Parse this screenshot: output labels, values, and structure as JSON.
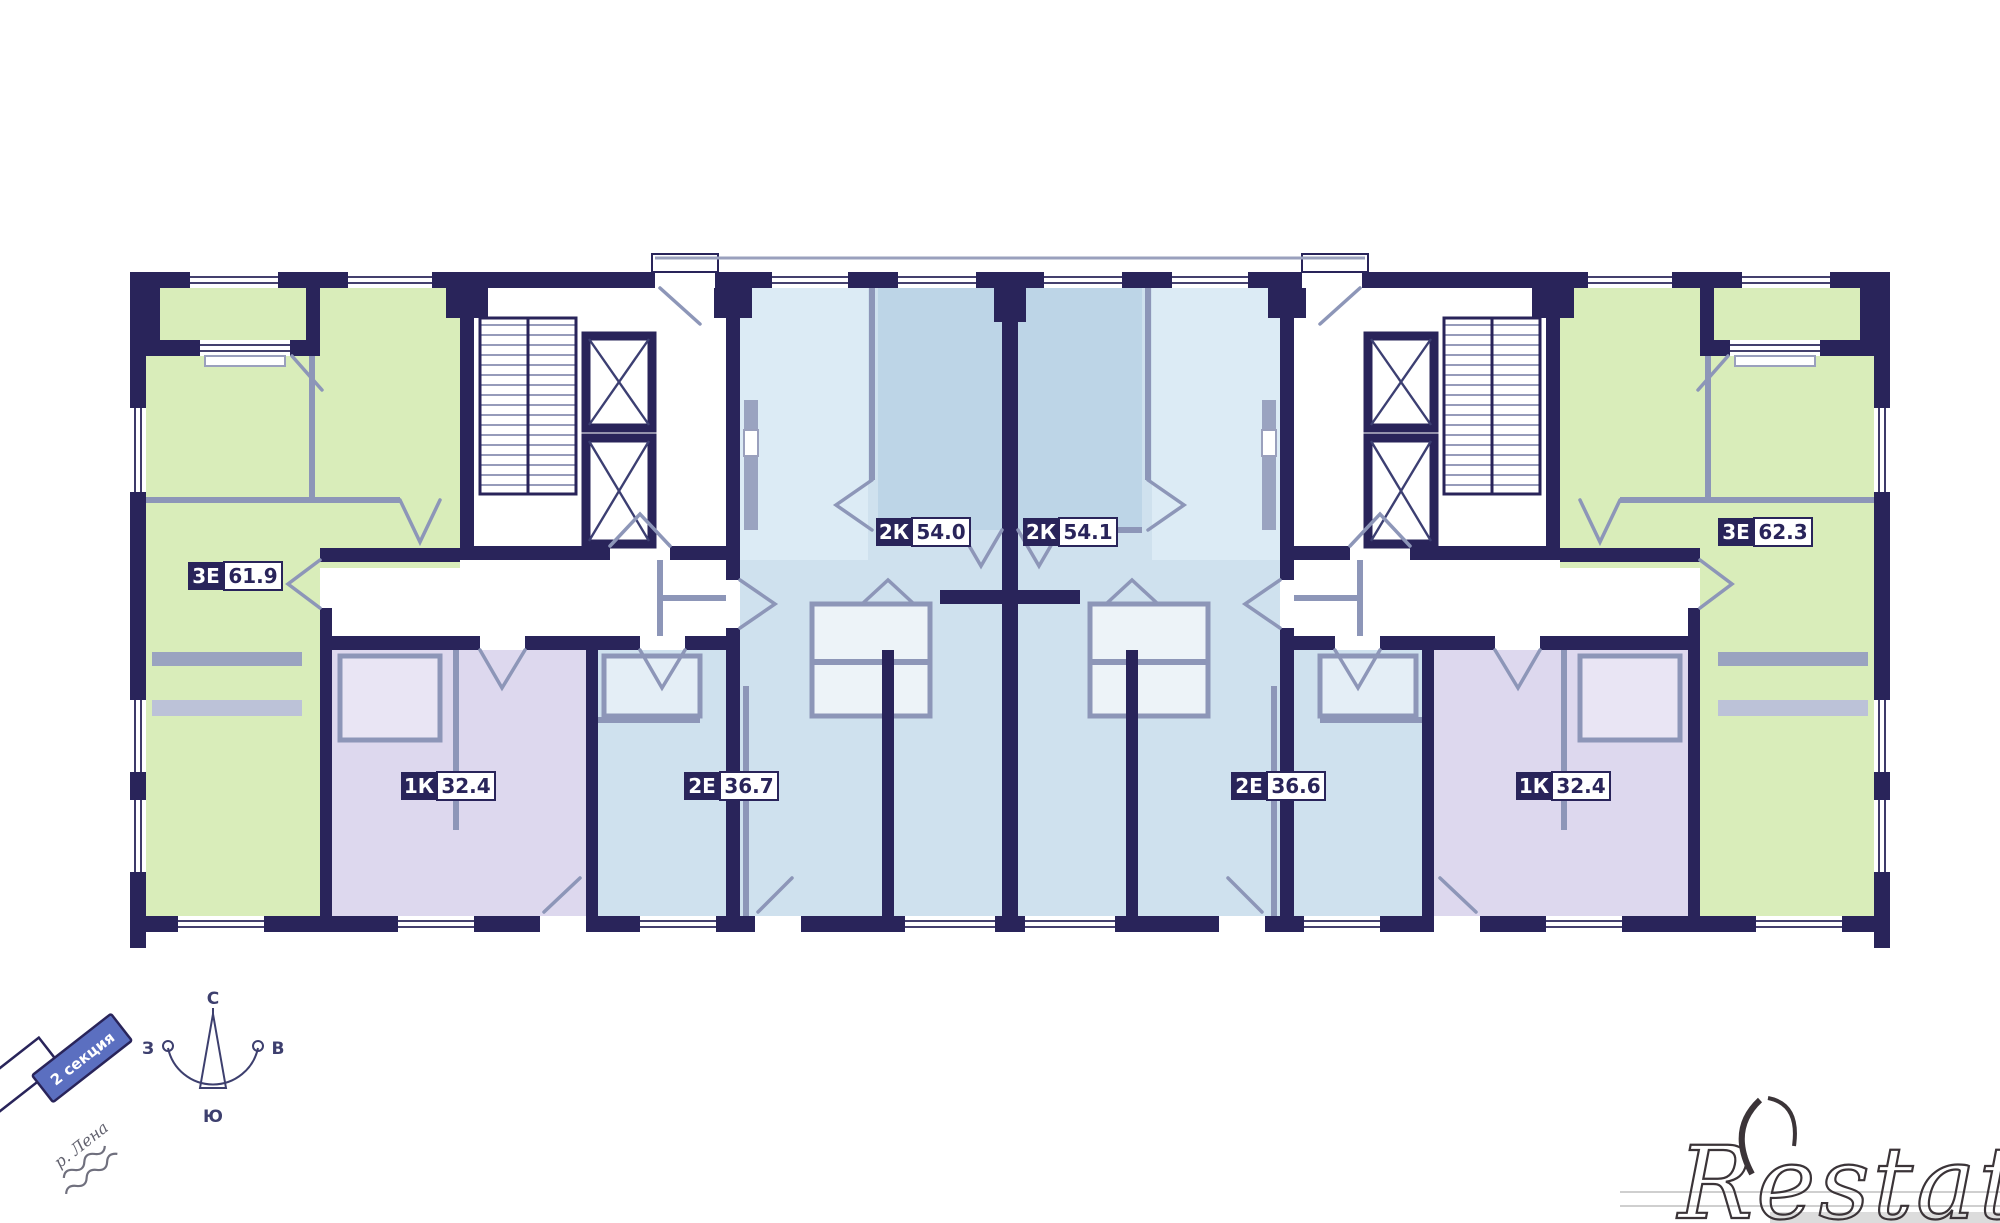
{
  "plan": {
    "apartments": [
      {
        "type": "3Е",
        "area": "61.9"
      },
      {
        "type": "1К",
        "area": "32.4"
      },
      {
        "type": "2Е",
        "area": "36.7"
      },
      {
        "type": "2К",
        "area": "54.0"
      },
      {
        "type": "2К",
        "area": "54.1"
      },
      {
        "type": "2Е",
        "area": "36.6"
      },
      {
        "type": "1К",
        "area": "32.4"
      },
      {
        "type": "3Е",
        "area": "62.3"
      }
    ]
  },
  "compass": {
    "north": "С",
    "east": "В",
    "south": "Ю",
    "west": "З"
  },
  "labels": {
    "section": "2 секция",
    "river": "р. Лена",
    "watermark": "Restate"
  },
  "legend_colors": {
    "walls": "#29245a",
    "apartment_green": "#d9edba",
    "apartment_blue": "#cfe1ee",
    "apartment_blue_dark": "#bdd5e7",
    "apartment_lavender": "#ddd8ee",
    "partition_gray": "#8d96b8",
    "section_badge_blue": "#5b6fc0"
  }
}
